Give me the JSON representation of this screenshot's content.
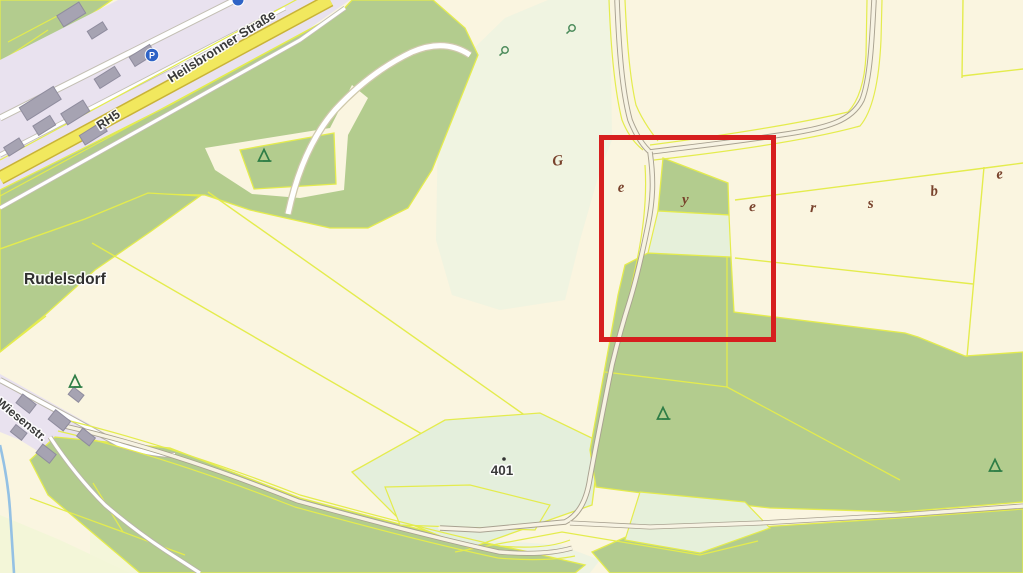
{
  "map": {
    "view_type": "cadastral-topographic-map",
    "labels": {
      "place": "Rudelsdorf",
      "main_street": "Heilsbronner Straße",
      "road_ref": "RH5",
      "side_street": "Wiesenstr.",
      "elevation_point": "401",
      "parking_symbol": "P"
    },
    "scattered_area_letters": [
      {
        "ch": "G"
      },
      {
        "ch": "e"
      },
      {
        "ch": "y"
      },
      {
        "ch": "e"
      },
      {
        "ch": "r"
      },
      {
        "ch": "s"
      },
      {
        "ch": "b"
      },
      {
        "ch": "e"
      }
    ],
    "highlight_box": {
      "x": 599,
      "y": 135,
      "width": 177,
      "height": 207,
      "color": "#d61e1e"
    },
    "colors": {
      "farmland_cream": "#faf5e0",
      "grass_green": "#b3cc8e",
      "meadow_mint": "#e6f0da",
      "pale_wash": "#edf3e0",
      "light_chartreuse": "#f3f6d8",
      "parcel_line_yellow": "#e4ec4d",
      "road_yellow": "#f1e85e",
      "road_yellow_casing": "#c9b337",
      "track_fill": "#f7f3e3",
      "track_casing": "#a8a190",
      "white_road_casing": "#c2beb2",
      "residential_lavender": "#e9e2ef",
      "building_gray": "#a6a3b2",
      "stream_blue": "#94c1e4",
      "area_label_brown": "#78422c",
      "map_label_dark": "#3a3a3a",
      "parking_blue": "#2e63c6",
      "tree_green": "#2e7d46",
      "highlight_red": "#d61e1e"
    }
  }
}
